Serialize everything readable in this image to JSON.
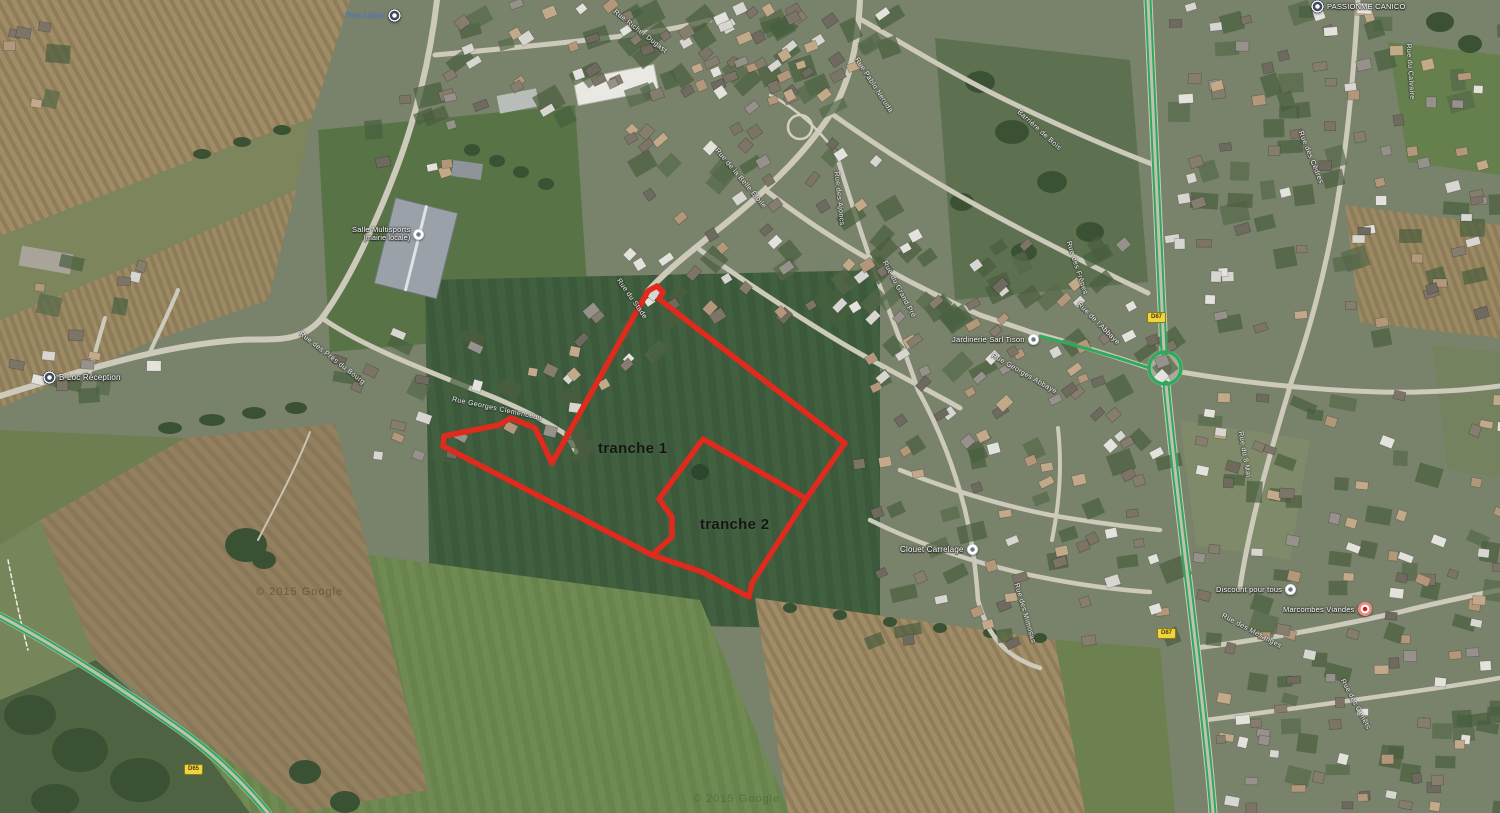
{
  "map": {
    "description": "Aerial satellite view with development parcel outline",
    "attribution": "© 2015 Google"
  },
  "tranches": {
    "t1": {
      "label": "tranche 1"
    },
    "t2": {
      "label": "tranche 2"
    }
  },
  "overlay": {
    "outer_path": "M648,291 L657,286 L663,292 L659,299 L845,443 L806,499 L752,583 L749,597 L702,572 L652,555 L443,446 L444,436 L499,425 L511,418 L535,428 L552,463 Z",
    "divider_path": "M703,439 L805,498 M703,439 L659,499 L672,517 L672,537 L652,555"
  },
  "colors": {
    "parcel_red": "#e02a1e",
    "route_green": "#2fa95c",
    "shield_yellow": "#f2d43c",
    "road_gray": "#cdcabc"
  },
  "pois": [
    {
      "name": "poi-top-left",
      "text": "Piou Liaud"
    },
    {
      "name": "poi-salle",
      "text": "Salle Multisports",
      "text2": "(mairie locale)"
    },
    {
      "name": "poi-b-loc",
      "text": "B Loc Réception"
    },
    {
      "name": "poi-passion",
      "text": "PASSIONME CANICO"
    },
    {
      "name": "poi-jardinerie",
      "text": "Jardinerie Sarl Tison"
    },
    {
      "name": "poi-clouet",
      "text": "Clouet Carrelage"
    },
    {
      "name": "poi-discount",
      "text": "Discount pour tous"
    },
    {
      "name": "poi-marcombes",
      "text": "Marcombes Viandes"
    }
  ],
  "streets": [
    {
      "name": "Rue Richer Dugast"
    },
    {
      "name": "Rue Pablo Neruda"
    },
    {
      "name": "Rue de la Belle Étoile"
    },
    {
      "name": "Barrière de Bois"
    },
    {
      "name": "Rue des Frênes"
    },
    {
      "name": "Rue des Ajoncs"
    },
    {
      "name": "Rue du Grand Pré"
    },
    {
      "name": "Rue Georges Abbaye"
    },
    {
      "name": "Rue du 8 Mai"
    },
    {
      "name": "Rue du Calvaire"
    },
    {
      "name": "Rue des Cèdres"
    },
    {
      "name": "Rue Georges Clemenceau"
    },
    {
      "name": "Rue des Prés du Bourg"
    },
    {
      "name": "Rue du Stade"
    },
    {
      "name": "Rue de l'Abbaye"
    },
    {
      "name": "Rue des Genêts"
    },
    {
      "name": "Rue des Mésanges"
    },
    {
      "name": "Rue des Mimosas"
    }
  ],
  "shields": [
    {
      "text": "D87"
    },
    {
      "text": "D87"
    },
    {
      "text": "D65"
    }
  ],
  "watermarks": [
    {
      "text": "© 2015 Google"
    },
    {
      "text": "© 2015 Google"
    }
  ]
}
